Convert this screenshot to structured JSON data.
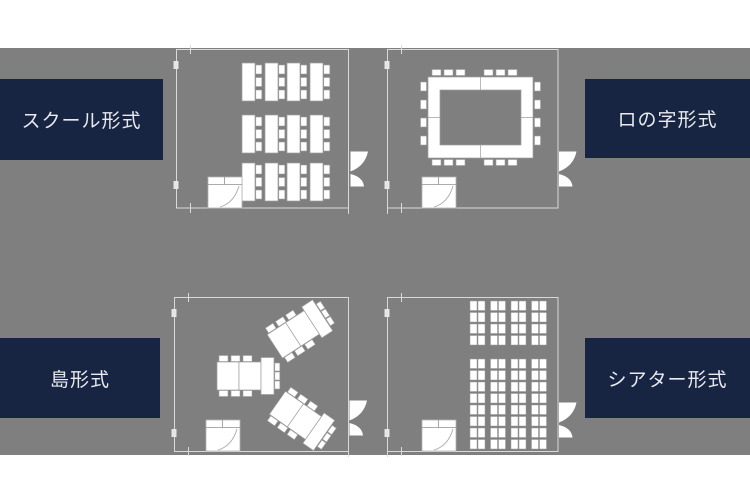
{
  "colors": {
    "background": "#ffffff",
    "canvas_gray": "#7f7f7f",
    "label_navy": "#172442",
    "label_text": "#e8eaef",
    "wall_line": "#d9d9d9",
    "furniture_fill": "#ffffff",
    "furniture_stroke": "#9e9e9e"
  },
  "layouts": [
    {
      "id": "school",
      "label": "スクール形式",
      "position": "top-left",
      "label_side": "left"
    },
    {
      "id": "ro-no-ji",
      "label": "ロの字形式",
      "position": "top-right",
      "label_side": "right"
    },
    {
      "id": "island",
      "label": "島形式",
      "position": "bottom-left",
      "label_side": "left"
    },
    {
      "id": "theater",
      "label": "シアター形式",
      "position": "bottom-right",
      "label_side": "right"
    }
  ]
}
